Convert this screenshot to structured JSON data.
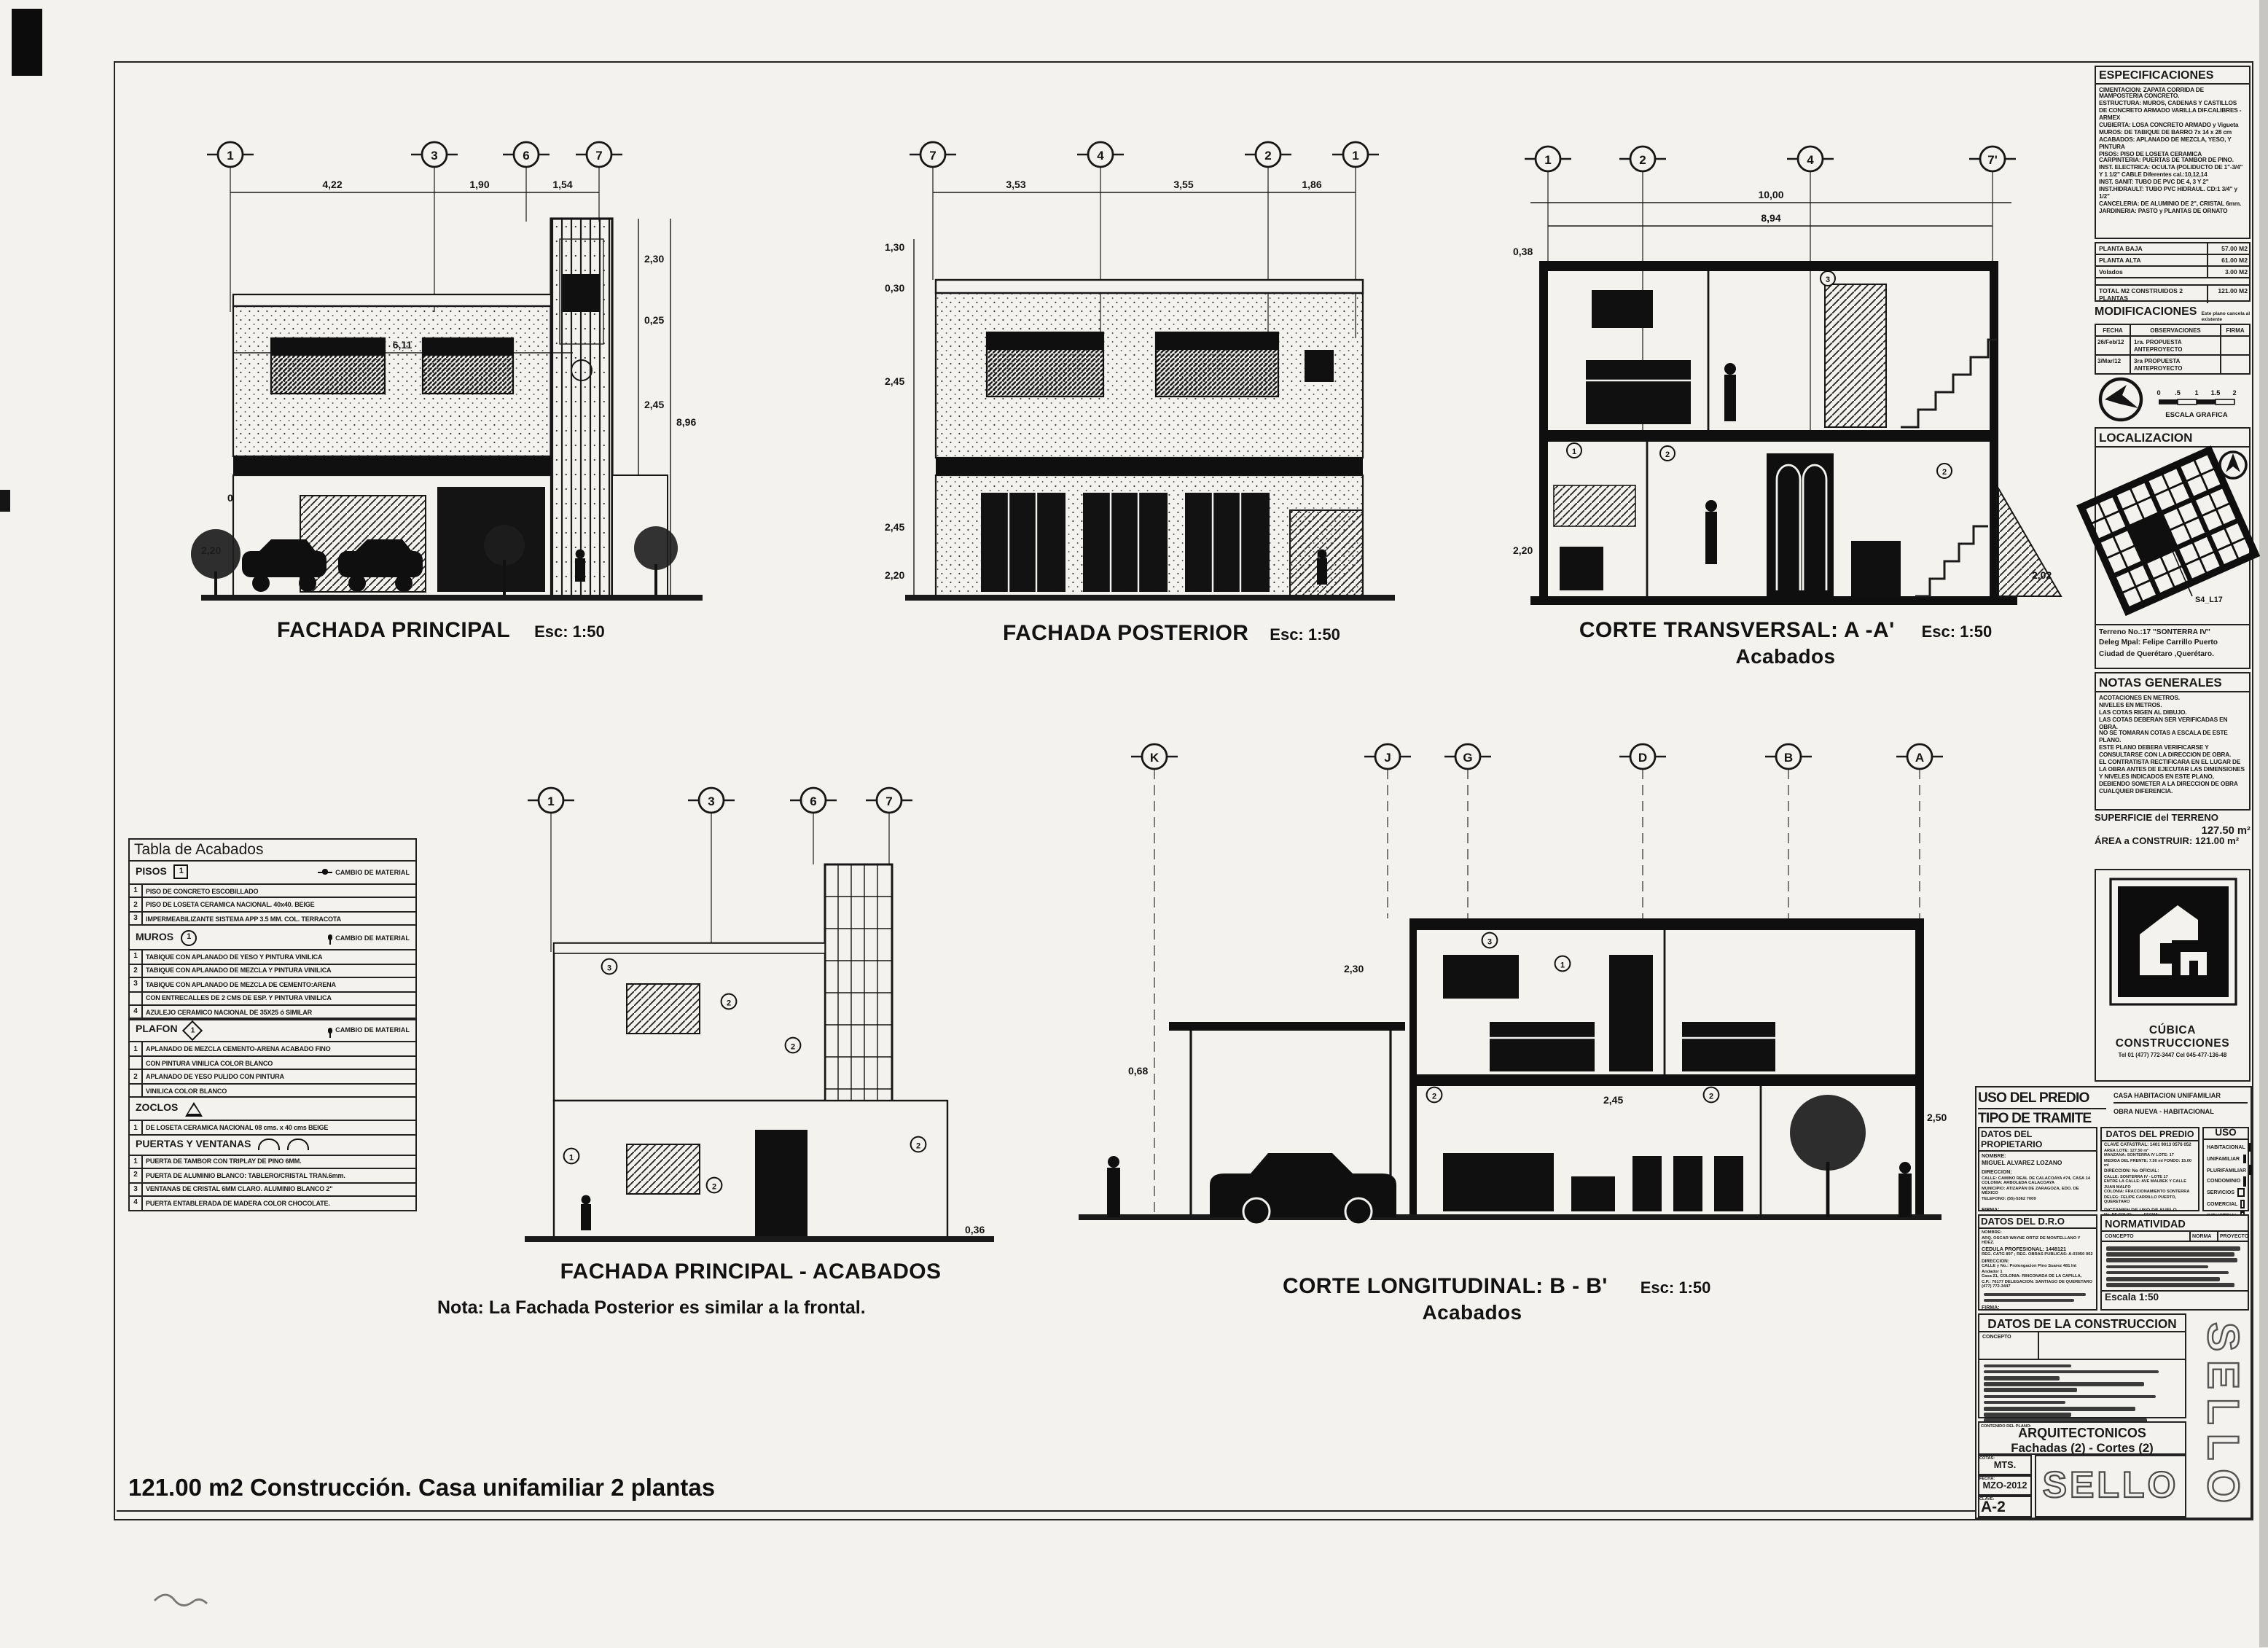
{
  "sheet": {
    "footer": "121.00 m2 Construcción. Casa unifamiliar 2 plantas"
  },
  "fachada_principal": {
    "title": "FACHADA PRINCIPAL",
    "scale": "Esc: 1:50",
    "axes": [
      "1",
      "3",
      "6",
      "7"
    ],
    "dims_top": [
      "4,22",
      "1,90",
      "1,54"
    ],
    "dim_width": "6,11",
    "dims_right": [
      "2,30",
      "0,25",
      "2,45",
      "8,96",
      "2,45",
      "0,36"
    ],
    "dims_left": [
      "0,50",
      "2,20"
    ]
  },
  "fachada_posterior": {
    "title": "FACHADA POSTERIOR",
    "scale": "Esc: 1:50",
    "axes": [
      "7",
      "4",
      "2",
      "1"
    ],
    "dims_top": [
      "3,53",
      "3,55",
      "1,86"
    ],
    "dims_left": [
      "1,30",
      "0,30",
      "2,45",
      "2,45",
      "2,20"
    ]
  },
  "corte_transversal": {
    "title": "CORTE TRANSVERSAL: A -A'",
    "subtitle": "Acabados",
    "scale": "Esc: 1:50",
    "axes": [
      "1",
      "2",
      "4",
      "7'"
    ],
    "dims_top": [
      "10,00",
      "8,94"
    ],
    "dims_side": [
      "0,38",
      "2,20",
      "2,02"
    ],
    "tags": [
      "3",
      "2",
      "1",
      "2"
    ]
  },
  "fachada_acabados": {
    "title": "FACHADA PRINCIPAL - ACABADOS",
    "note": "Nota: La Fachada Posterior es similar a la frontal.",
    "axes": [
      "1",
      "3",
      "6",
      "7"
    ],
    "dim_base": "0,36",
    "tags": [
      "3",
      "2",
      "2",
      "1",
      "2",
      "2"
    ]
  },
  "corte_longitudinal": {
    "title": "CORTE LONGITUDINAL: B - B'",
    "subtitle": "Acabados",
    "scale": "Esc: 1:50",
    "axes": [
      "K",
      "J",
      "G",
      "D",
      "B",
      "A"
    ],
    "dims": [
      "0,68",
      "2,30",
      "2,45",
      "2,50"
    ],
    "tags": [
      "2",
      "3",
      "2",
      "1"
    ]
  },
  "tabla_acabados": {
    "title": "Tabla de Acabados",
    "pisos": {
      "name": "PISOS",
      "symbol": "1",
      "note": "CAMBIO DE MATERIAL",
      "rows": [
        {
          "n": "1",
          "t": "PISO DE CONCRETO ESCOBILLADO"
        },
        {
          "n": "2",
          "t": "PISO DE LOSETA CERAMICA NACIONAL. 40x40. BEIGE"
        },
        {
          "n": "3",
          "t": "IMPERMEABILIZANTE SISTEMA APP 3.5 MM. COL. TERRACOTA"
        }
      ]
    },
    "muros": {
      "name": "MUROS",
      "symbol": "1",
      "note": "CAMBIO DE MATERIAL",
      "rows": [
        {
          "n": "1",
          "t": "TABIQUE CON APLANADO DE YESO Y PINTURA VINILICA"
        },
        {
          "n": "2",
          "t": "TABIQUE CON APLANADO DE MEZCLA Y PINTURA VINILICA"
        },
        {
          "n": "3",
          "t": "TABIQUE CON APLANADO DE MEZCLA DE CEMENTO:ARENA"
        },
        {
          "n": "",
          "t": "CON ENTRECALLES DE 2 CMS DE ESP. Y PINTURA VINILICA"
        },
        {
          "n": "4",
          "t": "AZULEJO CERAMICO NACIONAL DE 35X25 ó SIMILAR"
        }
      ]
    },
    "plafon": {
      "name": "PLAFON",
      "symbol": "1",
      "note": "CAMBIO DE MATERIAL",
      "rows": [
        {
          "n": "1",
          "t": "APLANADO DE MEZCLA CEMENTO-ARENA ACABADO FINO"
        },
        {
          "n": "",
          "t": "CON PINTURA VINILICA COLOR BLANCO"
        },
        {
          "n": "2",
          "t": "APLANADO DE YESO PULIDO CON PINTURA"
        },
        {
          "n": "",
          "t": "VINILICA COLOR BLANCO"
        }
      ]
    },
    "zoclos": {
      "name": "ZOCLOS",
      "symbol": "1",
      "rows": [
        {
          "n": "1",
          "t": "DE LOSETA CERAMICA NACIONAL 08 cms. x 40 cms BEIGE"
        }
      ]
    },
    "puertas": {
      "name": "PUERTAS Y VENTANAS",
      "rows": [
        {
          "n": "1",
          "t": "PUERTA DE TAMBOR CON TRIPLAY DE PINO 6MM."
        },
        {
          "n": "2",
          "t": "PUERTA DE ALUMINIO BLANCO: TABLERO/CRISTAL TRAN.6mm."
        },
        {
          "n": "3",
          "t": "VENTANAS DE CRISTAL 6MM CLARO. ALUMINIO BLANCO 2\""
        },
        {
          "n": "4",
          "t": "PUERTA ENTABLERADA DE MADERA COLOR CHOCOLATE."
        }
      ]
    }
  },
  "especificaciones": {
    "title": "ESPECIFICACIONES",
    "lines": [
      "CIMENTACION: ZAPATA CORRIDA DE MAMPOSTERIA CONCRETO.",
      "ESTRUCTURA: MUROS, CADENAS Y CASTILLOS DE CONCRETO ARMADO VARILLA DIF.CALIBRES -ARMEX",
      "CUBIERTA: LOSA CONCRETO ARMADO y Vigueta",
      "MUROS: DE TABIQUE DE BARRO 7x 14 x 28 cm ACABADOS: APLANADO DE MEZCLA, YESO, Y PINTURA",
      "PISOS: PISO DE LOSETA CERAMICA",
      "CARPINTERIA: PUERTAS DE TAMBOR DE PINO.",
      "INST. ELECTRICA: OCULTA (POLIDUCTO DE 1\"-3/4\" Y 1 1/2\" CABLE Diferentes cal.:10,12,14",
      "INST. SANIT: TUBO DE PVC DE 4, 3 Y 2\"",
      "INST.HIDRAULT: TUBO PVC HIDRAUL. CD:1 3/4\" y 1/2\"",
      "CANCELERIA: DE ALUMINIO DE 2\", CRISTAL 6mm.",
      "JARDINERIA: PASTO y PLANTAS DE ORNATO"
    ]
  },
  "areas": {
    "rows": [
      {
        "label": "PLANTA BAJA",
        "value": "57.00 M2"
      },
      {
        "label": "PLANTA ALTA",
        "value": "61.00 M2"
      },
      {
        "label": "Volados",
        "value": "3.00 M2"
      },
      {
        "label": "TOTAL M2 CONSTRUIDOS 2 PLANTAS",
        "value": "121.00 M2"
      }
    ]
  },
  "modificaciones": {
    "title": "MODIFICACIONES",
    "note": "Este plano cancela al existente",
    "headers": [
      "FECHA",
      "OBSERVACIONES",
      "FIRMA"
    ],
    "rows": [
      {
        "fecha": "26/Feb/12",
        "obs": "1ra. PROPUESTA ANTEPROYECTO",
        "firma": ""
      },
      {
        "fecha": "3/Mar/12",
        "obs": "3ra PROPUESTA ANTEPROYECTO",
        "firma": ""
      }
    ]
  },
  "escala_grafica": {
    "labels": [
      "0",
      ".5",
      "1",
      "1.5",
      "2"
    ],
    "caption": "ESCALA  GRAFICA"
  },
  "localizacion": {
    "title": "LOCALIZACION",
    "lot_label": "S4_L17",
    "address": [
      "Terreno No.:17 \"SONTERRA IV\"",
      "Deleg Mpal: Felipe Carrillo Puerto",
      "Ciudad de Querétaro ,Querétaro."
    ]
  },
  "notas": {
    "title": "NOTAS GENERALES",
    "lines": [
      "ACOTACIONES EN METROS.",
      "NIVELES EN METROS.",
      "LAS COTAS RIGEN AL DIBUJO.",
      "LAS COTAS DEBERAN SER VERIFICADAS EN OBRA.",
      "NO SE TOMARAN COTAS A ESCALA DE ESTE PLANO.",
      "ESTE PLANO DEBERA VERIFICARSE Y CONSULTARSE CON LA DIRECCION DE OBRA.",
      "EL CONTRATISTA RECTIFICARA EN EL LUGAR DE LA OBRA ANTES DE EJECUTAR LAS DIMENSIONES Y NIVELES INDICADOS EN ESTE PLANO, DEBIENDO SOMETER A LA DIRECCION DE OBRA CUALQUIER DIFERENCIA."
    ]
  },
  "superficie": {
    "line1": "SUPERFICIE del TERRENO",
    "value1": "127.50 m²",
    "line2": "ÁREA a CONSTRUIR: 121.00 m²"
  },
  "empresa": {
    "nombre": "CÚBICA CONSTRUCCIONES",
    "contacto": "Tel 01 (477) 772-3447      Cel 045-477-136-48"
  },
  "tramite": {
    "uso_label": "USO DEL PREDIO",
    "uso_value": "CASA HABITACION UNIFAMILIAR",
    "tipo_label": "TIPO DE TRAMITE",
    "tipo_value": "OBRA NUEVA - HABITACIONAL"
  },
  "propietario": {
    "title": "DATOS DEL PROPIETARIO",
    "nombre_label": "NOMBRE:",
    "nombre": "MIGUEL ALVAREZ LOZANO",
    "dir_label": "DIRECCION:",
    "dir0": "CALLE: CAMINO REAL DE CALACOAYA #74, CASA 14",
    "dir1": "COLONIA: ARBOLEDA CALACOAYA",
    "dir2": "MUNICIPIO: ATIZAPÁN DE ZARAGOZA, EDO. DE MÉXICO",
    "dir3": "TELEFONO: (55)-5362 7009",
    "firma": "FIRMA:"
  },
  "predio": {
    "title": "DATOS DEL PREDIO",
    "lines": [
      "CLAVE CATASTRAL: 1401 9013 0576 052",
      "AREA LOTE: 127.50 m²",
      "MANZANA: SONTERRA IV      LOTE: 17",
      "MEDIDA DEL FRENTE: 7.50 ml     FONDO: 15.00 ml",
      "DIRECCION:                  No OFICIAL:",
      "CALLE: SONTERRA IV - LOTE 17",
      "ENTRE LA CALLE: AVE MALBEK Y CALLE JUAN MALFO",
      "COLONIA: FRACCIONAMIENTO SONTERRA",
      "DELEG: FELIPE CARRILLO PUERTO, QUERETARO"
    ],
    "dictamen": "DICTAMEN DE USO DE SUELO",
    "folio": "No. DE FOLIO:",
    "fecha": "FECHA:"
  },
  "uso_tabla": {
    "title": "USO",
    "items": [
      {
        "label": "HABITACIONAL",
        "checked": true
      },
      {
        "label": "UNIFAMILIAR",
        "checked": true
      },
      {
        "label": "PLURIFAMILIAR",
        "checked": false
      },
      {
        "label": "CONDOMINIO",
        "checked": false
      },
      {
        "label": "SERVICIOS",
        "checked": false
      },
      {
        "label": "COMERCIAL",
        "checked": false
      },
      {
        "label": "INDUSTRIAL",
        "checked": false
      }
    ]
  },
  "dro": {
    "title": "DATOS DEL D.R.O",
    "lines": [
      "NOMBRE:",
      "ARQ. OSCAR WAYNE ORTIZ DE MONTELLANO Y HDEZ.",
      "CEDULA PROFESIONAL: 1448121",
      "REG. CATG 897 ;  REG. OBRAS PUBLICAS: A-03050 002",
      "DIRECCION:",
      "CALLE y No.: Prolongacion Pino Suarez 481 Int Andador 1",
      "Casa 21, COLONIA: RINCONADA DE LA CAPILLA,",
      "C.P.: 76177  DELEGACION: SANTIAGO DE QUERETARO",
      "(477) 772-3447"
    ],
    "firma": "FIRMA:"
  },
  "normatividad": {
    "title": "NORMATIVIDAD",
    "col1": "CONCEPTO",
    "col2": "NORMA",
    "col3": "PROYECTO",
    "escala": "Escala 1:50"
  },
  "construccion": {
    "title": "DATOS DE LA CONSTRUCCION",
    "header": "CONCEPTO"
  },
  "titleblock": {
    "contenido_label": "CONTENIDO DEL PLANO:",
    "contenido": "ARQUITECTONICOS",
    "contenido_sub": "Fachadas (2) - Cortes (2)",
    "cotas_label": "COTAS:",
    "cotas": "MTS.",
    "fecha_label": "FECHA:",
    "fecha": "MZO-2012",
    "clave_label": "CLAVE:",
    "clave": "A-2",
    "sello": "SELLO"
  }
}
